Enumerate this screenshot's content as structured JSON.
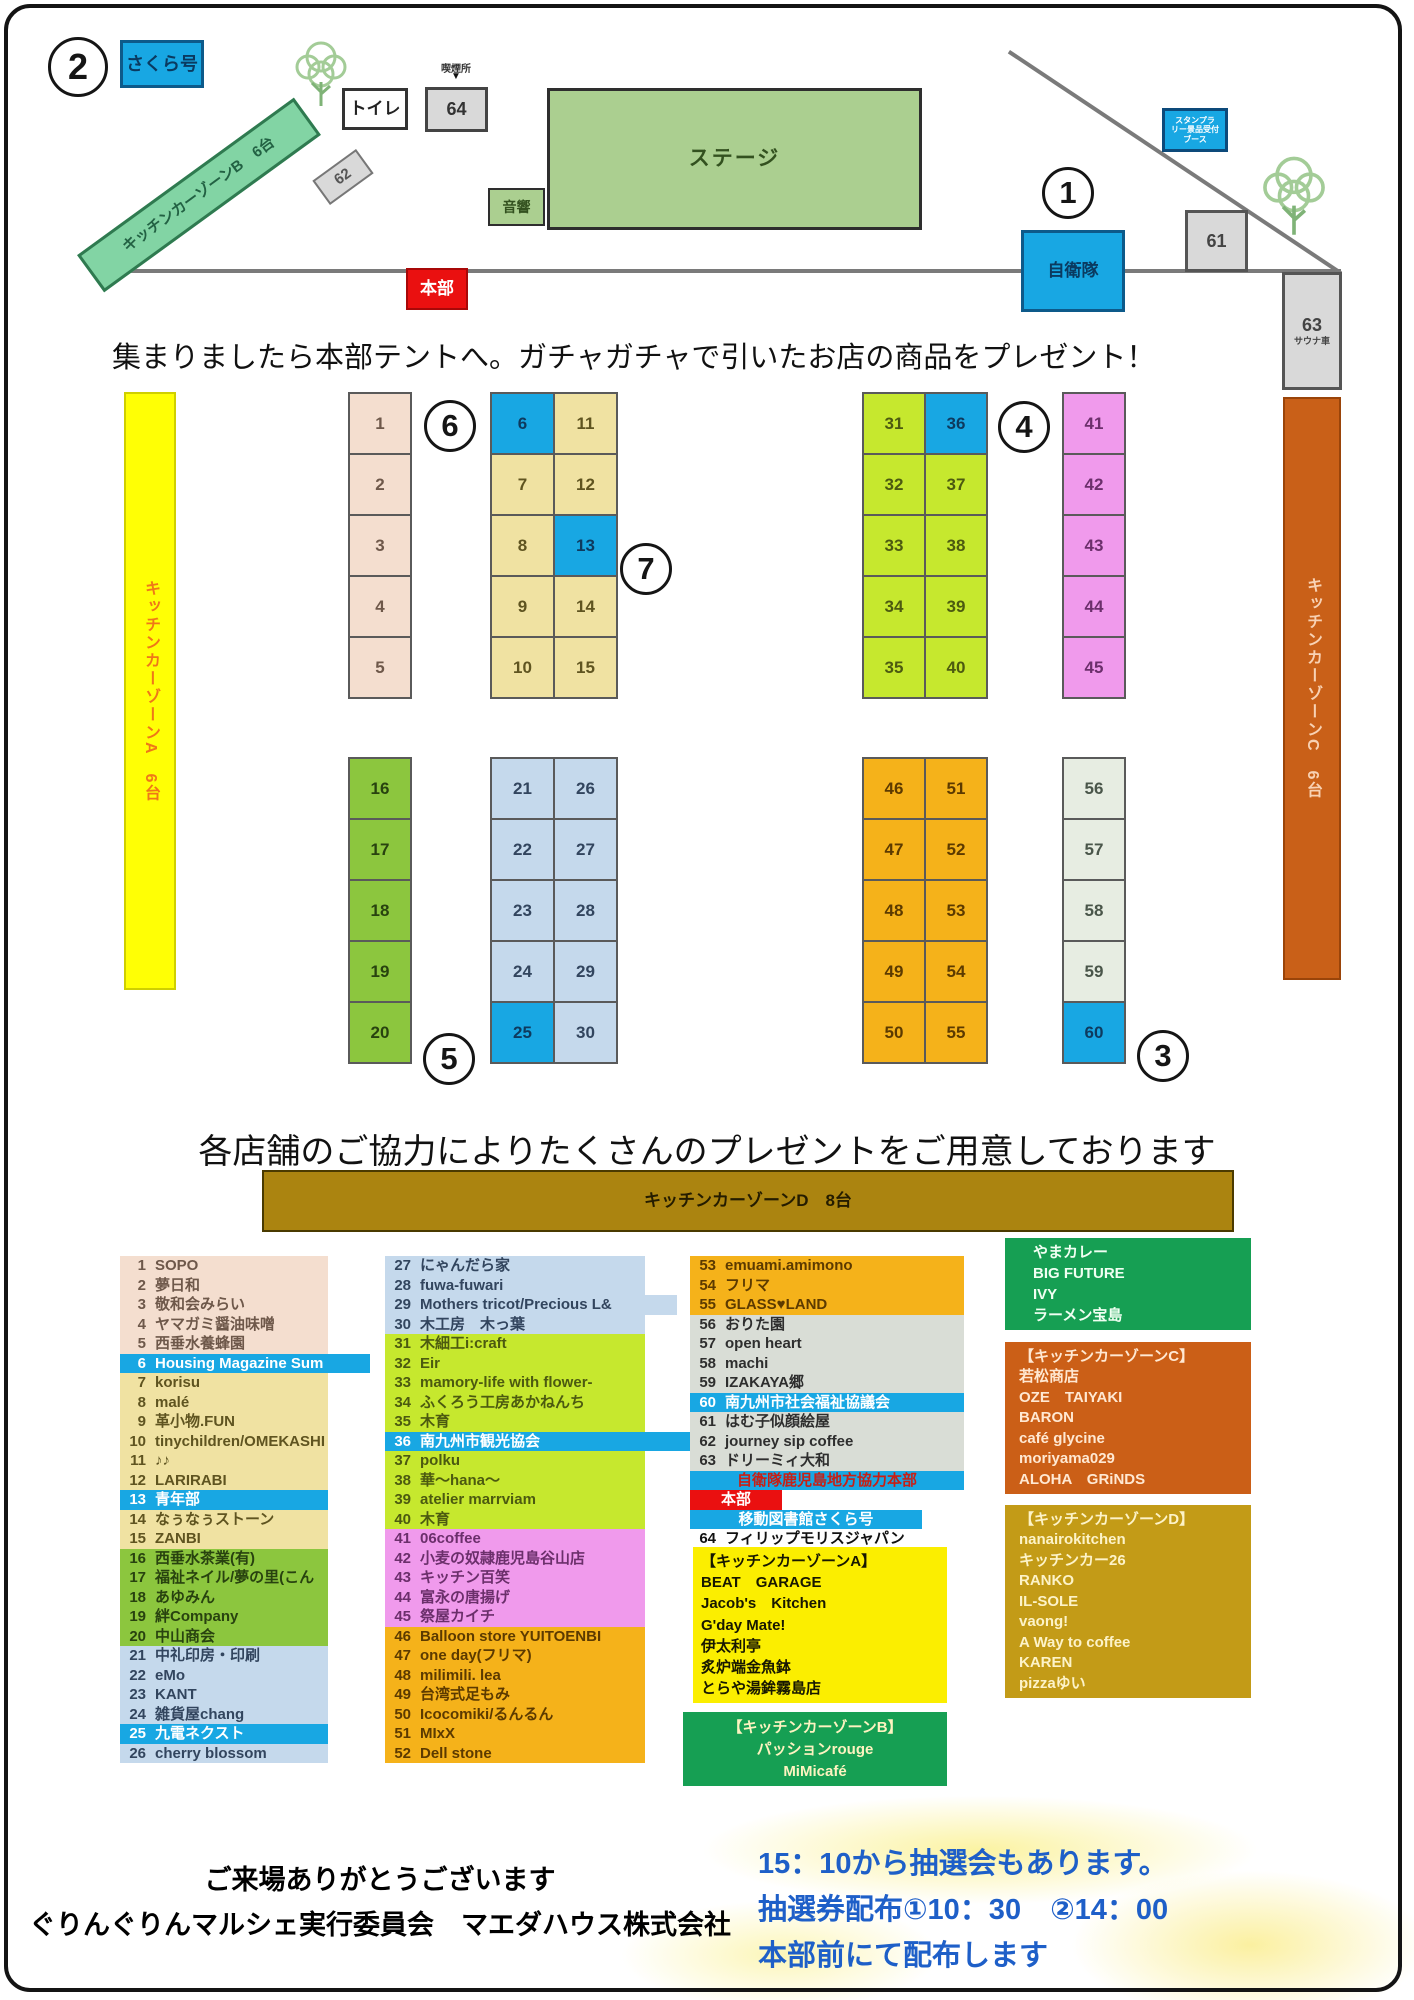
{
  "colors": {
    "peach": [
      "#f4decf",
      "#6e584a"
    ],
    "khaki": [
      "#f0e2a2",
      "#5f5420"
    ],
    "green": [
      "#8cc63e",
      "#28420f"
    ],
    "lightblue": [
      "#c5d9ec",
      "#32455e"
    ],
    "lime": [
      "#c6e82e",
      "#4c5a10"
    ],
    "violet": [
      "#f09aec",
      "#6b2f6b"
    ],
    "orange": [
      "#f5b21a",
      "#5c3a00"
    ],
    "graygreen": [
      "#e7ede2",
      "#4a564a"
    ],
    "gray": [
      "#d9ddd6",
      "#2e2e2e"
    ],
    "bluecell": [
      "#18a7e3",
      "#0e3a5e"
    ],
    "bluerow": [
      "#18a7e3",
      "#ffffff"
    ],
    "redband": [
      "#ea1010",
      "#ffffff"
    ],
    "white": [
      "#ffffff",
      "#111111"
    ]
  },
  "map": {
    "circle_1": "1",
    "circle_2": "2",
    "circle_3": "3",
    "circle_4": "4",
    "circle_5": "5",
    "circle_6": "6",
    "circle_7": "7",
    "sakura_label": "さくら号",
    "toilet": "トイレ",
    "smoking": "喫煙所",
    "smoking_arrow": "▼",
    "booth64": "64",
    "stage": "ステージ",
    "sound": "音響",
    "kcz_b": "キッチンカーゾーンB　6台",
    "booth62": "62",
    "honbu": "本部",
    "jieitai": "自衛隊",
    "booth61": "61",
    "booth63": "63",
    "sauna": "サウナ車",
    "stamp_l1": "スタンプラ",
    "stamp_l2": "リー景品受付",
    "stamp_l3": "ブース",
    "kcz_a": "キッチンカーゾーンA　6台",
    "kcz_c": "キッチンカーゾーンC　6台",
    "kcz_d": "キッチンカーゾーンD　8台",
    "notice": "集まりましたら本部テントへ。ガチャガチャで引いたお店の商品をプレゼント！",
    "booth_groups": [
      {
        "left": 348,
        "top": 392,
        "cw": 62,
        "ch": 61,
        "color": "peach",
        "cells": [
          1,
          2,
          3,
          4,
          5
        ],
        "blue": []
      },
      {
        "left": 490,
        "top": 392,
        "cw": 63,
        "ch": 61,
        "color": "khaki",
        "cells": [
          6,
          7,
          8,
          9,
          10,
          11,
          12,
          13,
          14,
          15
        ],
        "blue": [
          6,
          13
        ]
      },
      {
        "left": 348,
        "top": 757,
        "cw": 62,
        "ch": 61,
        "color": "green",
        "cells": [
          16,
          17,
          18,
          19,
          20
        ],
        "blue": []
      },
      {
        "left": 490,
        "top": 757,
        "cw": 63,
        "ch": 61,
        "color": "lightblue",
        "cells": [
          21,
          22,
          23,
          24,
          25,
          26,
          27,
          28,
          29,
          30
        ],
        "blue": [
          25
        ]
      },
      {
        "left": 862,
        "top": 392,
        "cw": 62,
        "ch": 61,
        "color": "lime",
        "cells": [
          31,
          32,
          33,
          34,
          35,
          36,
          37,
          38,
          39,
          40
        ],
        "blue": [
          36
        ]
      },
      {
        "left": 1062,
        "top": 392,
        "cw": 62,
        "ch": 61,
        "color": "violet",
        "cells": [
          41,
          42,
          43,
          44,
          45
        ],
        "blue": []
      },
      {
        "left": 862,
        "top": 757,
        "cw": 62,
        "ch": 61,
        "color": "orange",
        "cells": [
          46,
          47,
          48,
          49,
          50,
          51,
          52,
          53,
          54,
          55
        ],
        "blue": []
      },
      {
        "left": 1062,
        "top": 757,
        "cw": 62,
        "ch": 61,
        "color": "graygreen",
        "cells": [
          56,
          57,
          58,
          59,
          60
        ],
        "blue": [
          60
        ]
      }
    ]
  },
  "list": {
    "heading": "各店舗のご協力によりたくさんのプレゼントをご用意しております",
    "columns": [
      {
        "left": 120,
        "top": 1256,
        "width": 208,
        "rowh": 19.5,
        "rows": [
          {
            "n": 1,
            "t": "SOPO",
            "bg": "peach"
          },
          {
            "n": 2,
            "t": "夢日和",
            "bg": "peach"
          },
          {
            "n": 3,
            "t": "敬和会みらい",
            "bg": "peach"
          },
          {
            "n": 4,
            "t": "ヤマガミ醤油味噌",
            "bg": "peach"
          },
          {
            "n": 5,
            "t": "西垂水養蜂園",
            "bg": "peach"
          },
          {
            "n": 6,
            "t": "Housing Magazine Sum",
            "bg": "bluerow",
            "w": 250
          },
          {
            "n": 7,
            "t": "korisu",
            "bg": "khaki"
          },
          {
            "n": 8,
            "t": "malé",
            "bg": "khaki"
          },
          {
            "n": 9,
            "t": "革小物.FUN",
            "bg": "khaki"
          },
          {
            "n": 10,
            "t": "tinychildren/OMEKASHI",
            "bg": "khaki"
          },
          {
            "n": 11,
            "t": "♪♪",
            "bg": "khaki"
          },
          {
            "n": 12,
            "t": "LARIRABI",
            "bg": "khaki"
          },
          {
            "n": 13,
            "t": "青年部",
            "bg": "bluerow"
          },
          {
            "n": 14,
            "t": "なぅなぅストーン",
            "bg": "khaki"
          },
          {
            "n": 15,
            "t": "ZANBI",
            "bg": "khaki"
          },
          {
            "n": 16,
            "t": "西垂水茶業(有)",
            "bg": "green"
          },
          {
            "n": 17,
            "t": "福祉ネイル/夢の里(こん",
            "bg": "green"
          },
          {
            "n": 18,
            "t": "あゆみん",
            "bg": "green"
          },
          {
            "n": 19,
            "t": "絆Company",
            "bg": "green"
          },
          {
            "n": 20,
            "t": "中山商会",
            "bg": "green"
          },
          {
            "n": 21,
            "t": "中礼印房・印刷",
            "bg": "lightblue"
          },
          {
            "n": 22,
            "t": "eMo",
            "bg": "lightblue"
          },
          {
            "n": 23,
            "t": "KANT",
            "bg": "lightblue"
          },
          {
            "n": 24,
            "t": "雑貨屋chang",
            "bg": "lightblue"
          },
          {
            "n": 25,
            "t": "九電ネクスト",
            "bg": "bluerow"
          },
          {
            "n": 26,
            "t": "cherry blossom",
            "bg": "lightblue"
          }
        ]
      },
      {
        "left": 385,
        "top": 1256,
        "width": 260,
        "rowh": 19.5,
        "rows": [
          {
            "n": 27,
            "t": "にゃんだら家",
            "bg": "lightblue"
          },
          {
            "n": 28,
            "t": "fuwa-fuwari",
            "bg": "lightblue"
          },
          {
            "n": 29,
            "t": "Mothers tricot/Precious L&",
            "bg": "lightblue",
            "w": 292
          },
          {
            "n": 30,
            "t": "木工房　木っ葉",
            "bg": "lightblue"
          },
          {
            "n": 31,
            "t": "木細工i:craft",
            "bg": "lime"
          },
          {
            "n": 32,
            "t": "Eir",
            "bg": "lime"
          },
          {
            "n": 33,
            "t": "mamory-life with flower-",
            "bg": "lime"
          },
          {
            "n": 34,
            "t": "ふくろう工房あかねんち",
            "bg": "lime"
          },
          {
            "n": 35,
            "t": "木育",
            "bg": "lime"
          },
          {
            "n": 36,
            "t": "南九州市観光協会",
            "bg": "bluerow",
            "w": 305
          },
          {
            "n": 37,
            "t": "polku",
            "bg": "lime"
          },
          {
            "n": 38,
            "t": "華〜hana〜",
            "bg": "lime"
          },
          {
            "n": 39,
            "t": "atelier marrviam",
            "bg": "lime"
          },
          {
            "n": 40,
            "t": "木育",
            "bg": "lime"
          },
          {
            "n": 41,
            "t": "06coffee",
            "bg": "violet"
          },
          {
            "n": 42,
            "t": "小麦の奴隷鹿児島谷山店",
            "bg": "violet"
          },
          {
            "n": 43,
            "t": "キッチン百笑",
            "bg": "violet"
          },
          {
            "n": 44,
            "t": "富永の唐揚げ",
            "bg": "violet"
          },
          {
            "n": 45,
            "t": "祭屋カイチ",
            "bg": "violet"
          },
          {
            "n": 46,
            "t": "Balloon store YUITOENBI",
            "bg": "orange"
          },
          {
            "n": 47,
            "t": "one day(フリマ)",
            "bg": "orange"
          },
          {
            "n": 48,
            "t": "milimili. lea",
            "bg": "orange"
          },
          {
            "n": 49,
            "t": "台湾式足もみ",
            "bg": "orange"
          },
          {
            "n": 50,
            "t": "Icocomiki/るんるん",
            "bg": "orange"
          },
          {
            "n": 51,
            "t": "MIxX",
            "bg": "orange"
          },
          {
            "n": 52,
            "t": "Dell stone",
            "bg": "orange"
          }
        ]
      },
      {
        "left": 690,
        "top": 1256,
        "width": 274,
        "rowh": 19.5,
        "rows": [
          {
            "n": 53,
            "t": "emuami.amimono",
            "bg": "orange"
          },
          {
            "n": 54,
            "t": "フリマ",
            "bg": "orange"
          },
          {
            "n": 55,
            "t": "GLASS♥LAND",
            "bg": "orange"
          },
          {
            "n": 56,
            "t": "おりた園",
            "bg": "gray"
          },
          {
            "n": 57,
            "t": "open heart",
            "bg": "gray"
          },
          {
            "n": 58,
            "t": "machi",
            "bg": "gray"
          },
          {
            "n": 59,
            "t": "IZAKAYA郷",
            "bg": "gray"
          },
          {
            "n": 60,
            "t": "南九州市社会福祉協議会",
            "bg": "bluerow"
          },
          {
            "n": 61,
            "t": "はむ子似顔絵屋",
            "bg": "gray"
          },
          {
            "n": 62,
            "t": "journey sip coffee",
            "bg": "gray"
          },
          {
            "n": 63,
            "t": "ドリーミィ大和",
            "bg": "gray"
          },
          {
            "band": "自衛隊鹿児島地方協力本部",
            "bg": "bluerow",
            "fg": "#c81f14",
            "w": 274
          },
          {
            "band": "本部",
            "bg": "redband",
            "w": 92
          },
          {
            "band": "移動図書館さくら号",
            "bg": "bluerow",
            "w": 232
          },
          {
            "n": 64,
            "t": "フィリップモリスジャパン",
            "bg": "white"
          }
        ]
      }
    ],
    "boxes": [
      {
        "name": "kitchen-car-zone-a-box",
        "left": 693,
        "top": 1547,
        "width": 254,
        "lineh": 21.2,
        "fs": 15,
        "bg": "#fbee00",
        "fg": "#171700",
        "pad": 8,
        "align": "left",
        "header": "【キッチンカーゾーンA】",
        "lines": [
          "BEAT　GARAGE",
          "Jacob's　Kitchen",
          "G'day Mate!",
          "伊太利亭",
          "炙炉端金魚鉢",
          "とらや湯鉾霧島店"
        ]
      },
      {
        "name": "kitchen-car-zone-b-box",
        "left": 683,
        "top": 1712,
        "width": 264,
        "lineh": 22,
        "fs": 15,
        "bg": "#169f53",
        "fg": "#fdf3c0",
        "pad": 0,
        "align": "center",
        "header": "【キッチンカーゾーンB】",
        "lines": [
          "パッションrouge",
          "MiMicafé"
        ]
      },
      {
        "name": "curry-shops-box",
        "left": 1005,
        "top": 1238,
        "width": 246,
        "lineh": 21,
        "fs": 15,
        "bg": "#169f53",
        "fg": "#f0fff2",
        "pad": 28,
        "align": "left",
        "lines": [
          "やまカレー",
          "BIG FUTURE",
          "IVY",
          "ラーメン宝島"
        ]
      },
      {
        "name": "kitchen-car-zone-c-box",
        "left": 1005,
        "top": 1342,
        "width": 246,
        "lineh": 20.5,
        "fs": 15,
        "bg": "#cb5f17",
        "fg": "#ffe8d2",
        "pad": 14,
        "align": "left",
        "header": "【キッチンカーゾーンC】",
        "lines": [
          "若松商店",
          "OZE　TAIYAKI",
          "BARON",
          "café glycine",
          "moriyama029",
          "ALOHA　GRiNDS"
        ]
      },
      {
        "name": "kitchen-car-zone-d-box",
        "left": 1005,
        "top": 1505,
        "width": 246,
        "lineh": 20.5,
        "fs": 15,
        "bg": "#c39b17",
        "fg": "#fdf3c8",
        "pad": 14,
        "align": "left",
        "header": "【キッチンカーゾーンD】",
        "lines": [
          "nanairokitchen",
          "キッチンカー26",
          "RANKO",
          "IL-SOLE",
          "vaong!",
          "A Way to coffee",
          "KAREN",
          "pizzaゆい"
        ]
      }
    ]
  },
  "footer": {
    "thanks1": "ご来場ありがとうございます",
    "thanks2": "ぐりんぐりんマルシェ実行委員会　マエダハウス株式会社",
    "lottery1": "15：10から抽選会もあります。",
    "lottery2": "抽選券配布①10：30　②14：00",
    "lottery3": "本部前にて配布します"
  }
}
